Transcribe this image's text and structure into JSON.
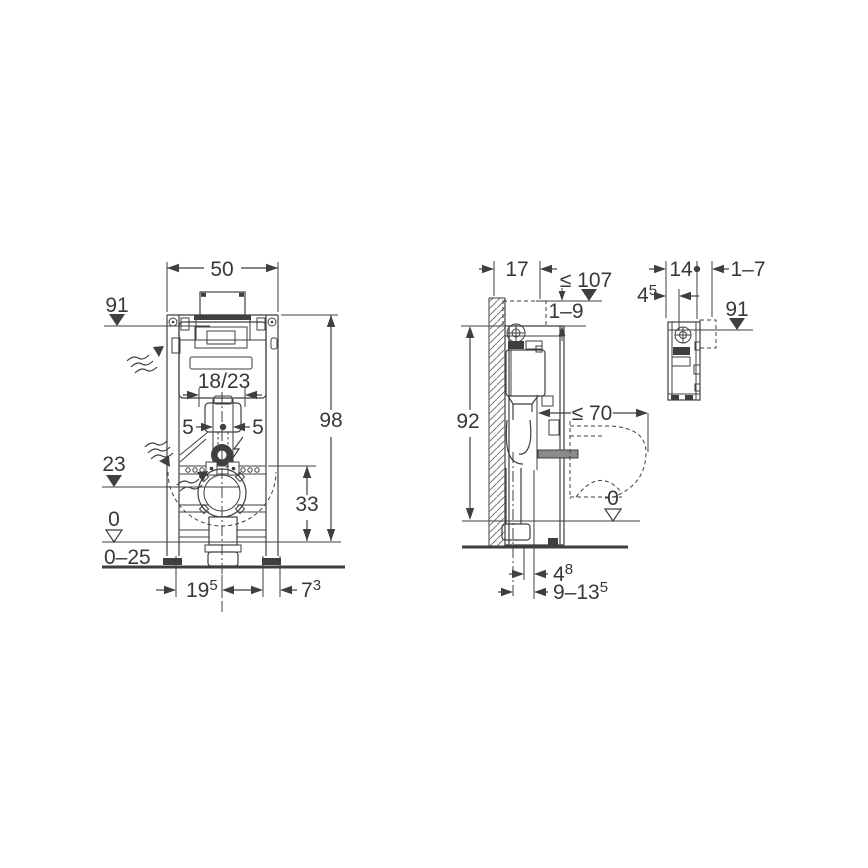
{
  "drawing": {
    "kind": "installation-element-dimension-drawing",
    "views": {
      "front_view": "frame front elevation",
      "side_view": "frame side section with wall and WC pan",
      "detail_view": "cistern top side detail"
    },
    "colors": {
      "background": "#ffffff",
      "line": "#3f3f3f",
      "text": "#383838"
    },
    "markers": {
      "level_filled": "filled-triangle-down",
      "level_open": "open-triangle-down",
      "datum_dot": "filled-circle",
      "flow_arrow": "wavy-flow-arrow"
    }
  },
  "front": {
    "width": "50",
    "height": "98",
    "plate_level": "91",
    "depth_options": "18/23",
    "offset_left": "5",
    "offset_right": "5",
    "outlet_level": "23",
    "outlet_span": "33",
    "zero_level": "0",
    "floor_range": "0–25",
    "left_span": {
      "main": "19",
      "sup": "5"
    },
    "right_span": {
      "main": "7",
      "sup": "3"
    }
  },
  "side": {
    "depth": "17",
    "max_height": "≤ 107",
    "cladding_range": "1–9",
    "height": "92",
    "max_pan_depth": "≤ 70",
    "zero_level": "0",
    "outlet_offset": {
      "main": "4",
      "sup": "8"
    },
    "outlet_range": {
      "main": "9–13",
      "sup": "5"
    }
  },
  "detail": {
    "width": "14",
    "cladding_range": "1–7",
    "offset": {
      "main": "4",
      "sup": "5"
    },
    "plate_level": "91"
  }
}
